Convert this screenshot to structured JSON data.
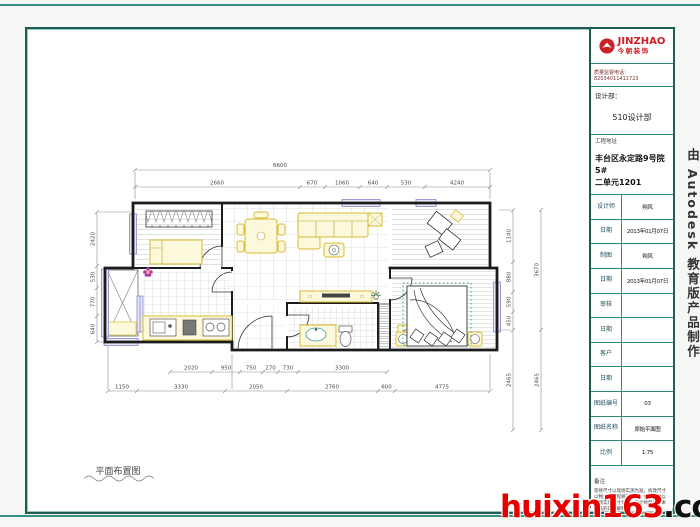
{
  "brand": {
    "name": "JINZHAO",
    "subtitle": "今朝装饰",
    "phone": "质量监督电话：82034011411723",
    "dept_label": "设计部：",
    "dept_value": "510设计部",
    "address_label": "工程地址",
    "address_line1": "丰台区永定路9号院5#",
    "address_line2": "二单元1201",
    "brand_red": "#cc2027"
  },
  "title_table": {
    "rows": [
      {
        "label": "设计师",
        "value": "朔风"
      },
      {
        "label": "日期",
        "value": "2013年01月07日"
      },
      {
        "label": "制图",
        "value": "朔风"
      },
      {
        "label": "日期",
        "value": "2013年01月07日"
      },
      {
        "label": "审核",
        "value": ""
      },
      {
        "label": "日期",
        "value": ""
      },
      {
        "label": "客户",
        "value": ""
      },
      {
        "label": "日期",
        "value": ""
      },
      {
        "label": "图纸编号",
        "value": "03"
      },
      {
        "label": "图纸名称",
        "value": "原始平面图"
      },
      {
        "label": "比例",
        "value": "1:75"
      }
    ],
    "remarks_label": "备注",
    "remarks": "装修尺寸以现场实测为准，拆改尺寸以物业及工程规范为准；如有改动以现场实际尺寸为准，设计师保留对本图纸的最终解释权。"
  },
  "watermarks": {
    "edu": "由 Autodesk 教育版产品制作",
    "site_red": "huixin163",
    "site_black": ".com"
  },
  "plan": {
    "caption": "平面布置图",
    "dims": {
      "top1": [
        "6600"
      ],
      "top2": [
        "2660",
        "670",
        "1060",
        "640",
        "530",
        "4240"
      ],
      "left": [
        "2420",
        "530",
        "770",
        "640"
      ],
      "right_inner": [
        "1140",
        "880",
        "590",
        "450",
        "2465"
      ],
      "right_outer": [
        "3670",
        "2465"
      ],
      "bottom_upper": [
        "2020",
        "950",
        "750",
        "270",
        "730",
        "3300"
      ],
      "bottom_lower": [
        "1150",
        "3330",
        "2050",
        "2760",
        "600",
        "4775"
      ]
    },
    "colors": {
      "wall": "#1b1b1b",
      "furniture": "#d8bd32",
      "window": "#8787cd",
      "accent_flower": "#b23aa0",
      "bed_dots": "#2fa08c",
      "frame_teal": "#1c5e52"
    }
  }
}
